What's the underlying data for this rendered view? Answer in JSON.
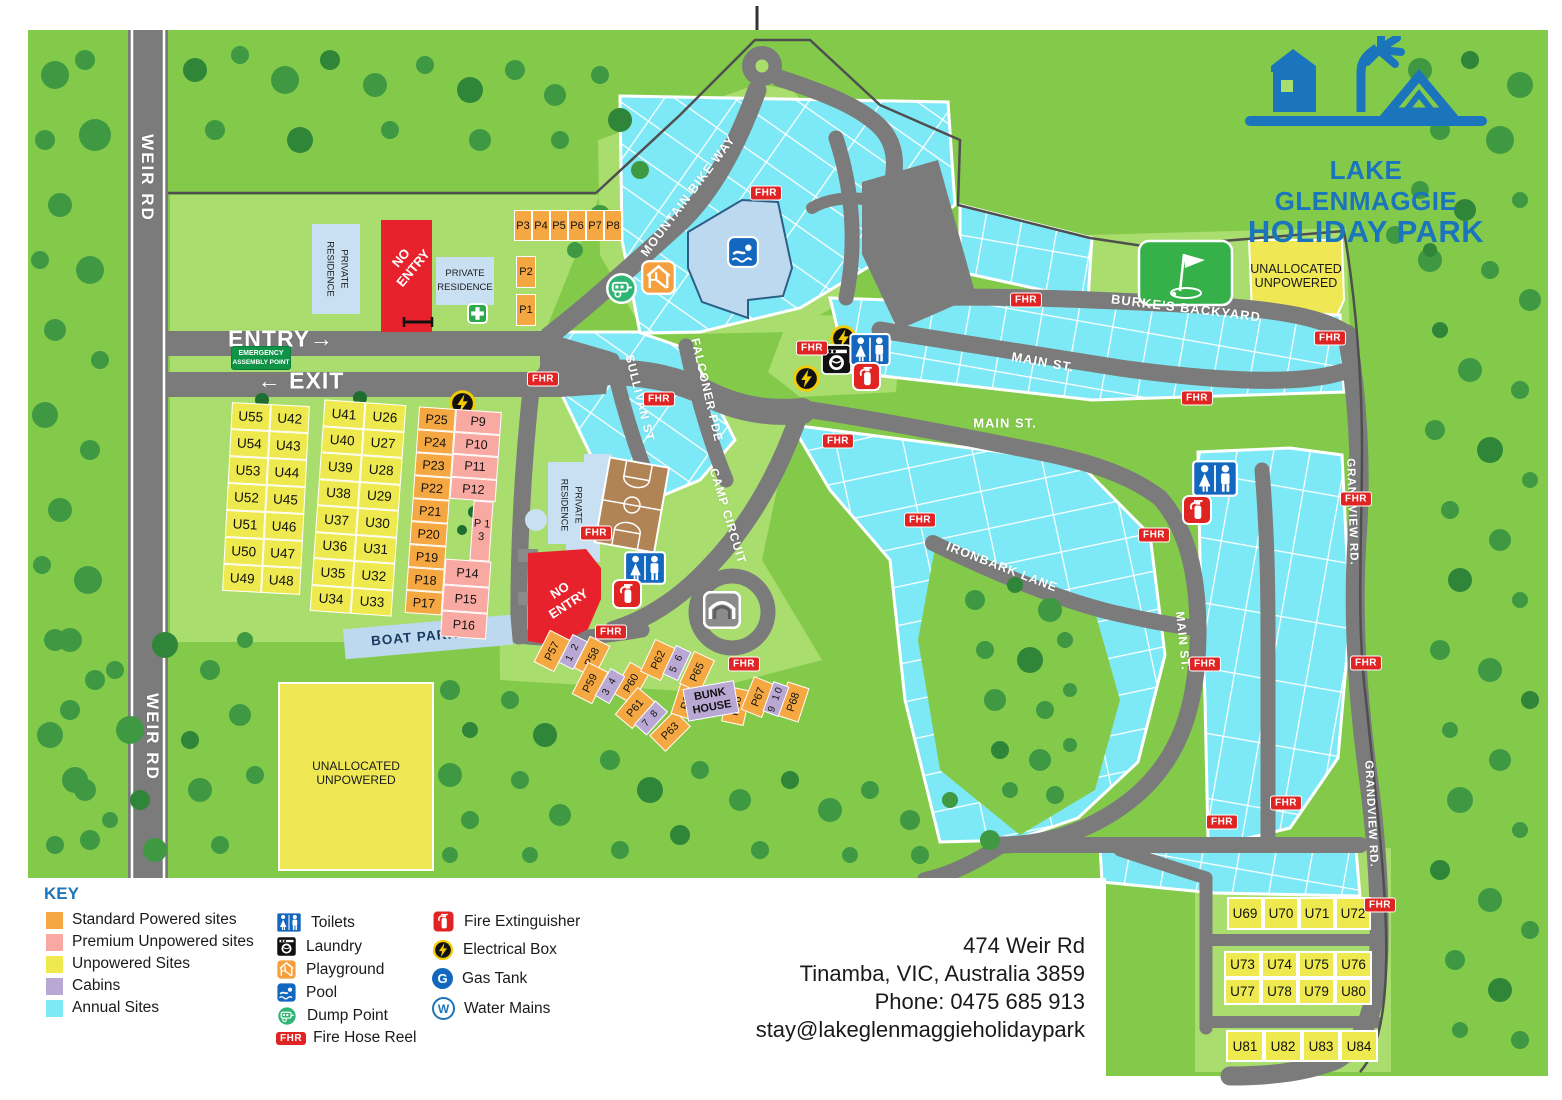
{
  "logo": {
    "line1": "LAKE GLENMAGGIE",
    "line2": "HOLIDAY PARK"
  },
  "roads": {
    "weir": "WEIR RD",
    "entry": "ENTRY→",
    "exit": "← EXIT",
    "mountain_bike_way": "MOUNTAIN BIKE WAY",
    "sullivan": "SULLIVAN ST",
    "falconer": "FALCONER PDE",
    "camp_circuit": "CAMP CIRCUIT",
    "main_st": "MAIN ST.",
    "ironbark": "IRONBARK LANE",
    "burkes": "BURKE'S BACKYARD",
    "grandview": "GRANDVIEW RD.",
    "boat_parking": "BOAT PARKING"
  },
  "labels": {
    "no_entry": "NO ENTRY",
    "private_residence": "PRIVATE RESIDENCE",
    "emergency_line1": "EMERGENCY",
    "emergency_line2": "ASSEMBLY POINT",
    "unallocated_line1": "UNALLOCATED",
    "unallocated_line2": "UNPOWERED",
    "bunk_house": "BUNK HOUSE"
  },
  "badges": {
    "fhr": "FHR",
    "gas_letter": "G",
    "water_letter": "W"
  },
  "sites": {
    "grid_a_col1": [
      "U55",
      "U54",
      "U53",
      "U52",
      "U51",
      "U50",
      "U49"
    ],
    "grid_a_col2": [
      "U42",
      "U43",
      "U44",
      "U45",
      "U46",
      "U47",
      "U48"
    ],
    "grid_b_col1": [
      "U41",
      "U40",
      "U39",
      "U38",
      "U37",
      "U36",
      "U35",
      "U34"
    ],
    "grid_b_col2": [
      "U26",
      "U27",
      "U28",
      "U29",
      "U30",
      "U31",
      "U32",
      "U33"
    ],
    "grid_c_orange": [
      "P25",
      "P24",
      "P23",
      "P22",
      "P21",
      "P20",
      "P19",
      "P18",
      "P17"
    ],
    "grid_c_pink_top": [
      "P9",
      "P10",
      "P11",
      "P12"
    ],
    "p13": "P 1 3",
    "grid_c_pink_bottom": [
      "P14",
      "P15",
      "P16"
    ],
    "top_row": [
      "P3",
      "P4",
      "P5",
      "P6",
      "P7",
      "P8"
    ],
    "top_col": [
      "P2",
      "P1"
    ],
    "u_row1": [
      "U69",
      "U70",
      "U71",
      "U72"
    ],
    "u_row2": [
      "U73",
      "U74",
      "U75",
      "U76"
    ],
    "u_row3": [
      "U77",
      "U78",
      "U79",
      "U80"
    ],
    "u_row4": [
      "U81",
      "U82",
      "U83",
      "U84"
    ],
    "camp_powered": [
      {
        "label": "P57",
        "x": 552,
        "y": 651,
        "r": -63
      },
      {
        "label": "P58",
        "x": 592,
        "y": 657,
        "r": -63
      },
      {
        "label": "P59",
        "x": 590,
        "y": 683,
        "r": -63
      },
      {
        "label": "P60",
        "x": 631,
        "y": 683,
        "r": -60
      },
      {
        "label": "P61",
        "x": 635,
        "y": 708,
        "r": -50
      },
      {
        "label": "P62",
        "x": 658,
        "y": 660,
        "r": -65
      },
      {
        "label": "P63",
        "x": 670,
        "y": 731,
        "r": -45
      },
      {
        "label": "P64",
        "x": 687,
        "y": 700,
        "r": -72
      },
      {
        "label": "P65",
        "x": 697,
        "y": 672,
        "r": -65
      },
      {
        "label": "P66",
        "x": 736,
        "y": 706,
        "r": -78
      },
      {
        "label": "P67",
        "x": 758,
        "y": 697,
        "r": -68
      },
      {
        "label": "P68",
        "x": 793,
        "y": 702,
        "r": -72
      }
    ],
    "camp_cabins": [
      {
        "label": "1 2",
        "x": 573,
        "y": 652,
        "r": -63
      },
      {
        "label": "3 4",
        "x": 610,
        "y": 686,
        "r": -60
      },
      {
        "label": "5 6",
        "x": 677,
        "y": 663,
        "r": -65
      },
      {
        "label": "7 8",
        "x": 651,
        "y": 718,
        "r": -48
      },
      {
        "label": "9 10",
        "x": 776,
        "y": 699,
        "r": -70
      }
    ]
  },
  "fhr_positions": [
    {
      "x": 766,
      "y": 193
    },
    {
      "x": 543,
      "y": 379
    },
    {
      "x": 659,
      "y": 399
    },
    {
      "x": 812,
      "y": 348
    },
    {
      "x": 1026,
      "y": 300
    },
    {
      "x": 1330,
      "y": 338
    },
    {
      "x": 1197,
      "y": 398
    },
    {
      "x": 838,
      "y": 441
    },
    {
      "x": 920,
      "y": 520
    },
    {
      "x": 1356,
      "y": 499
    },
    {
      "x": 1154,
      "y": 535
    },
    {
      "x": 596,
      "y": 533
    },
    {
      "x": 611,
      "y": 632
    },
    {
      "x": 744,
      "y": 664
    },
    {
      "x": 1205,
      "y": 664
    },
    {
      "x": 1366,
      "y": 663
    },
    {
      "x": 1286,
      "y": 803
    },
    {
      "x": 1222,
      "y": 822
    },
    {
      "x": 1380,
      "y": 905
    }
  ],
  "key": {
    "title": "KEY",
    "swatches": [
      {
        "label": "Standard Powered sites",
        "color": "#F5A841"
      },
      {
        "label": "Premium Unpowered sites",
        "color": "#F8A9A2"
      },
      {
        "label": "Unpowered Sites",
        "color": "#EDE94E"
      },
      {
        "label": "Cabins",
        "color": "#B9A8D4"
      },
      {
        "label": "Annual Sites",
        "color": "#7EE9F6"
      }
    ],
    "col2": [
      {
        "label": "Toilets"
      },
      {
        "label": "Laundry"
      },
      {
        "label": "Playground"
      },
      {
        "label": "Pool"
      },
      {
        "label": "Dump Point"
      },
      {
        "label": "Fire Hose Reel"
      }
    ],
    "col3": [
      {
        "label": "Fire Extinguisher"
      },
      {
        "label": "Electrical Box"
      },
      {
        "label": "Gas Tank"
      },
      {
        "label": "Water Mains"
      }
    ]
  },
  "contact": {
    "lines": [
      "474 Weir Rd",
      "Tinamba, VIC, Australia 3859",
      "Phone: 0475 685 913",
      "stay@lakeglenmaggieholidaypark"
    ]
  }
}
